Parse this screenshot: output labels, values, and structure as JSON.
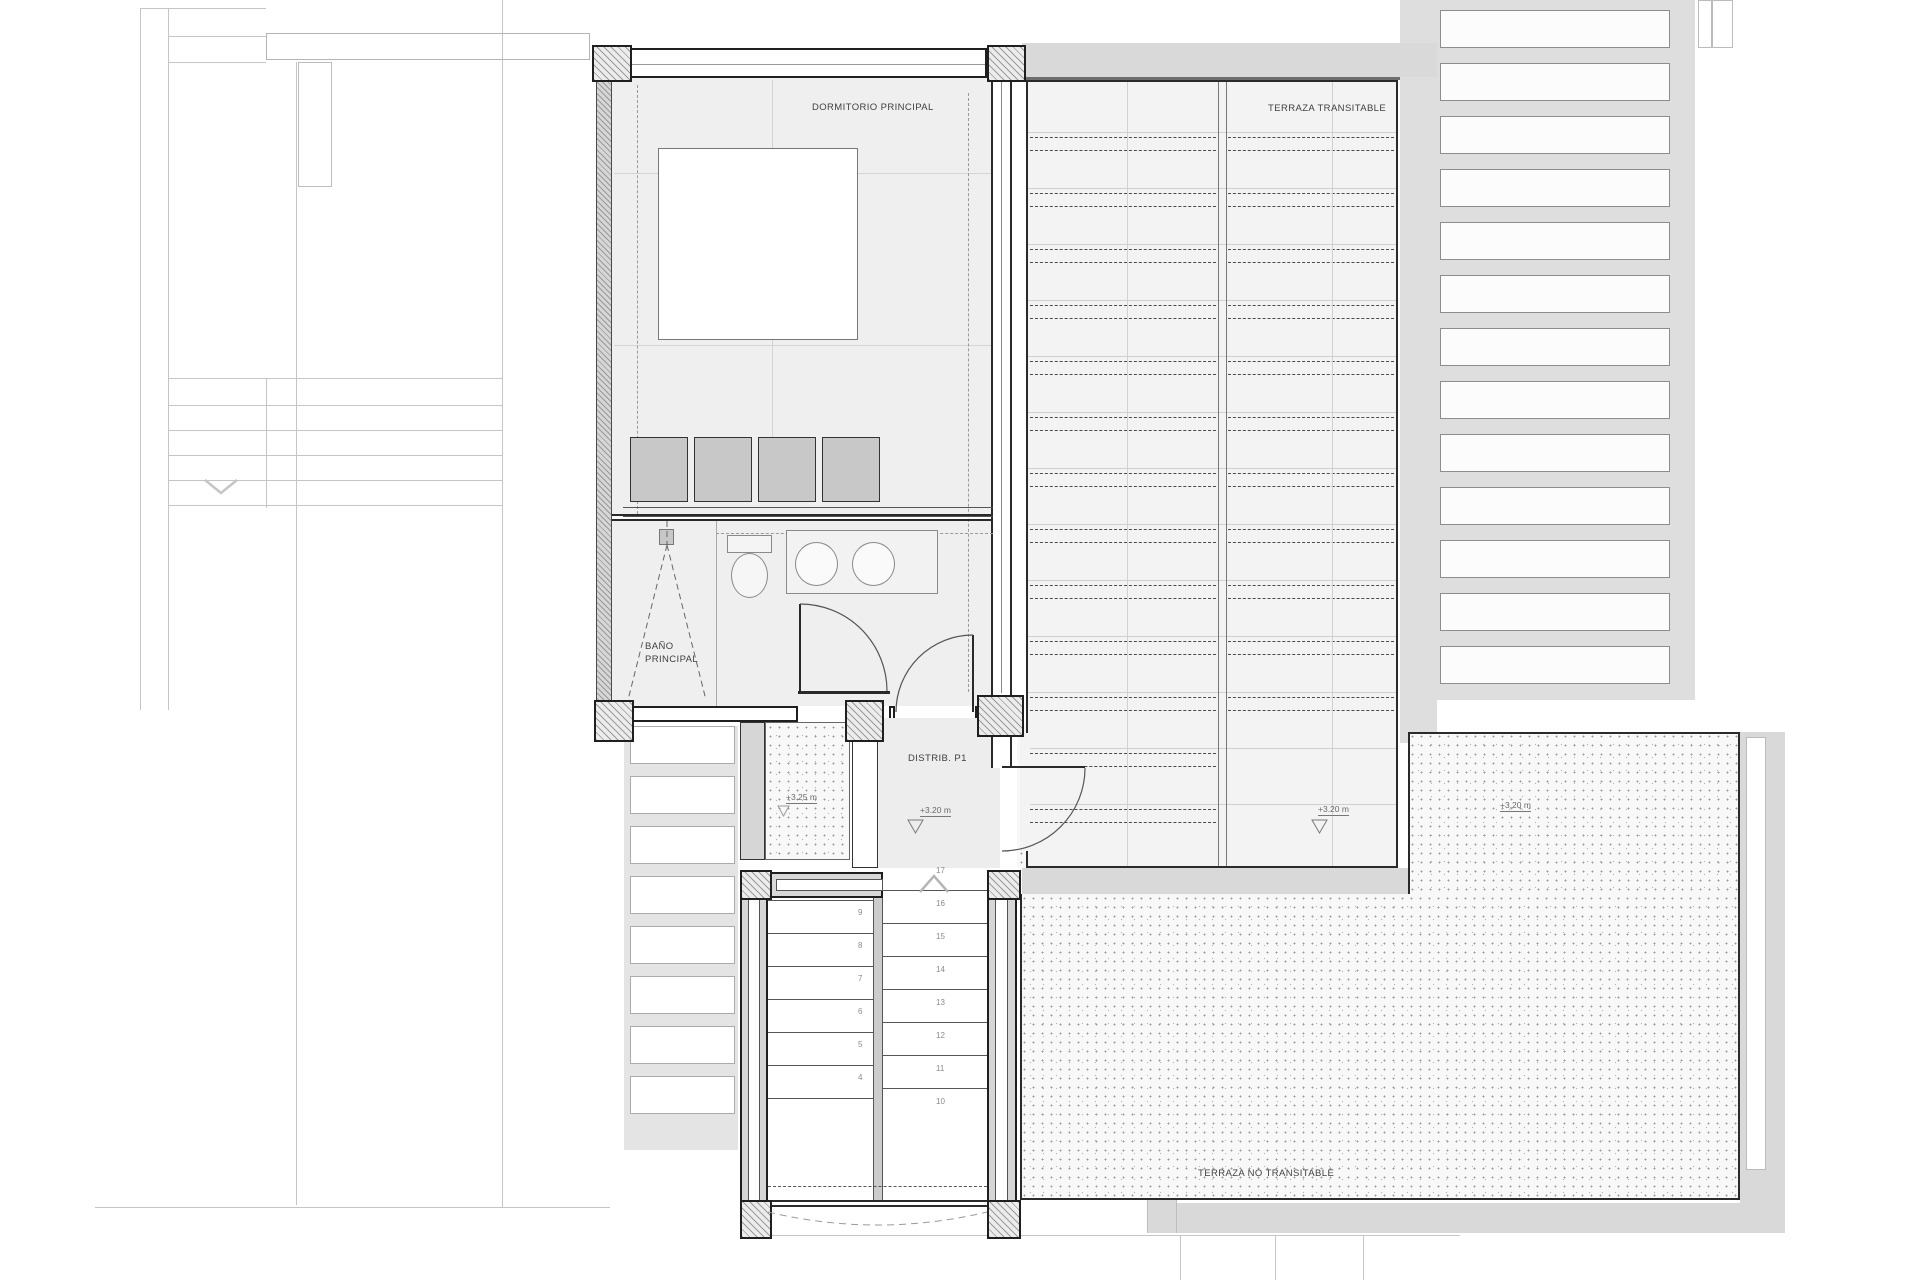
{
  "drawing": {
    "type": "floor-plan",
    "floor": "P1",
    "labels": {
      "bedroom": "DORMITORIO PRINCIPAL",
      "terrace_walkable": "TERRAZA TRANSITABLE",
      "bathroom_line1": "BAÑO",
      "bathroom_line2": "PRINCIPAL",
      "distributor": "DISTRIB. P1",
      "terrace_non_walkable": "TERRAZA NO TRANSITABLE"
    },
    "level_markers": [
      {
        "text": "+3.25 m",
        "x": 786,
        "y": 792,
        "area": "gravel-patio"
      },
      {
        "text": "+3.20 m",
        "x": 920,
        "y": 805,
        "area": "distributor"
      },
      {
        "text": "+3.20 m",
        "x": 1318,
        "y": 804,
        "area": "terrace-walkable"
      },
      {
        "text": "+3.20 m",
        "x": 1500,
        "y": 800,
        "area": "terrace-non-walkable"
      }
    ],
    "stairs": {
      "right_flight_numbers": [
        "17",
        "16",
        "15",
        "14",
        "13",
        "12",
        "11",
        "10"
      ],
      "left_flight_numbers": [
        "9",
        "8",
        "7",
        "6",
        "5",
        "4"
      ]
    },
    "colors": {
      "wall": "#2a2a2a",
      "gray_band": "#d9d9d9",
      "room_fill": "#efefef",
      "terrace_fill": "#f3f3f3",
      "closet_fill": "#c8c8c8",
      "dashed_line": "#4a4a4a",
      "faint_line": "#c5c5c5",
      "text": "#3f3f3f"
    }
  }
}
